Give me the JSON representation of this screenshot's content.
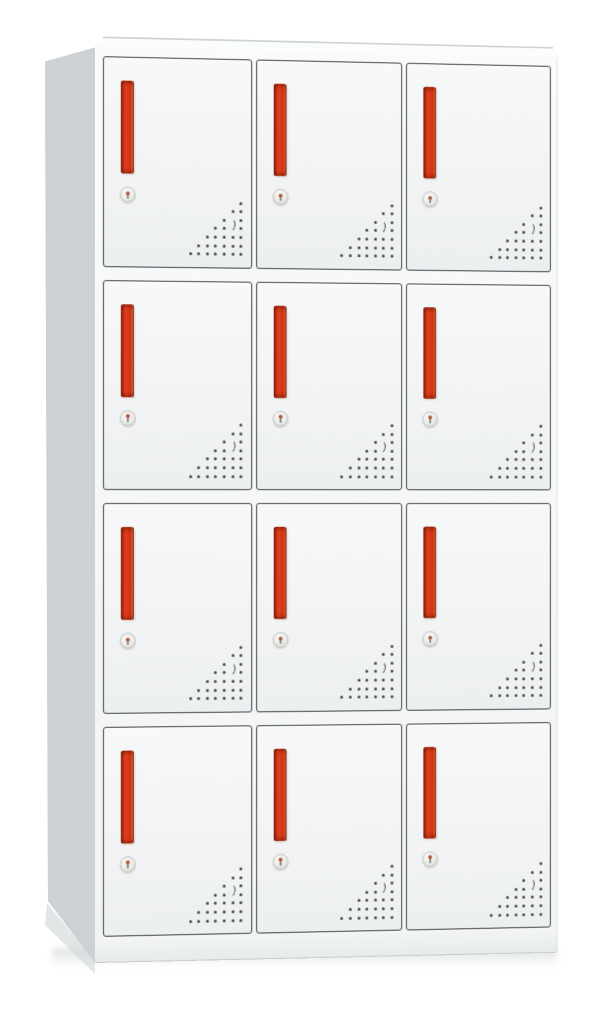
{
  "scene": {
    "type": "product-photo",
    "subject": "steel locker cabinet with twelve doors",
    "view": "front-left three-quarter view on white background"
  },
  "colors": {
    "bg": "#ffffff",
    "side": "#ccd1d4",
    "side_dark": "#bfc5c8",
    "top": "#fbfcfc",
    "door": "#f0f2f3",
    "door_edge": "#f1f3f4",
    "outline": "#3e4144",
    "handle": "#e04120",
    "handle_dark": "#b82c11",
    "handle_deep": "#7c1c09",
    "handle_glow": "#ea6636",
    "vent": "#474747",
    "lock": "#ebebe8",
    "lock_ring": "#c7c8c2",
    "keyhole": "#b15238",
    "base": "#f2f4f5",
    "shadow": "#cfd5d8"
  },
  "cabinet": {
    "rows": 4,
    "columns": 3,
    "door_count": 12,
    "door": {
      "handle": {
        "shape": "vertical-bar",
        "width_px": 13,
        "height_px": 93
      },
      "lock": {
        "shape": "round-keyhole",
        "diameter_px": 14
      },
      "vent": {
        "shape": "dot-triangle",
        "rows": 7,
        "cols": 7,
        "spacing": 8.6,
        "dot": 3,
        "skip": [
          [
            2,
            5
          ],
          [
            3,
            5
          ]
        ],
        "crescent": {
          "left": 36,
          "top": 16,
          "width": 9,
          "height": 12
        }
      }
    }
  }
}
